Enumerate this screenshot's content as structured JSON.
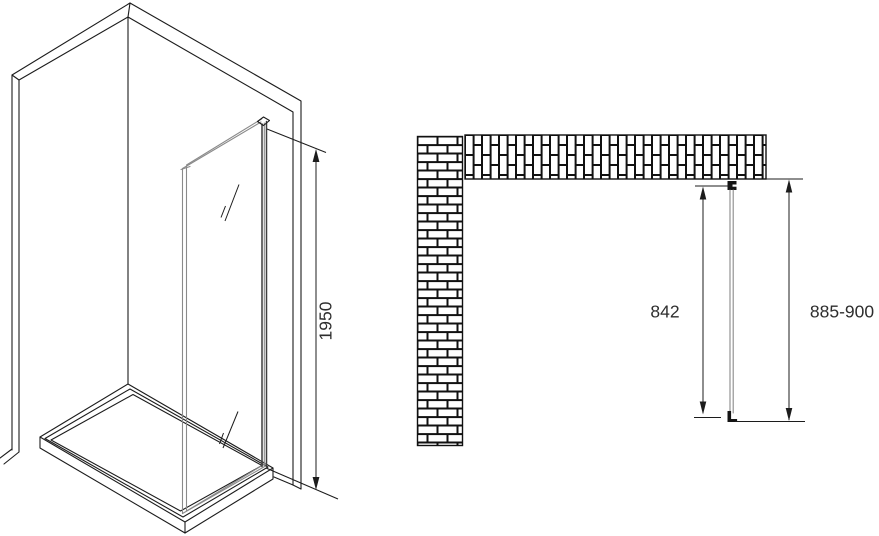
{
  "dimensions": {
    "panel_height": "1950",
    "glass_width": "842",
    "overall_width": "885-900"
  },
  "colors": {
    "background": "#ffffff",
    "line": "#1c1c1c",
    "glass_line": "#8a8a8a",
    "profile_line": "#3f3f3f",
    "brick_fill": "#ffffff",
    "mortar_fill": "#111111"
  }
}
